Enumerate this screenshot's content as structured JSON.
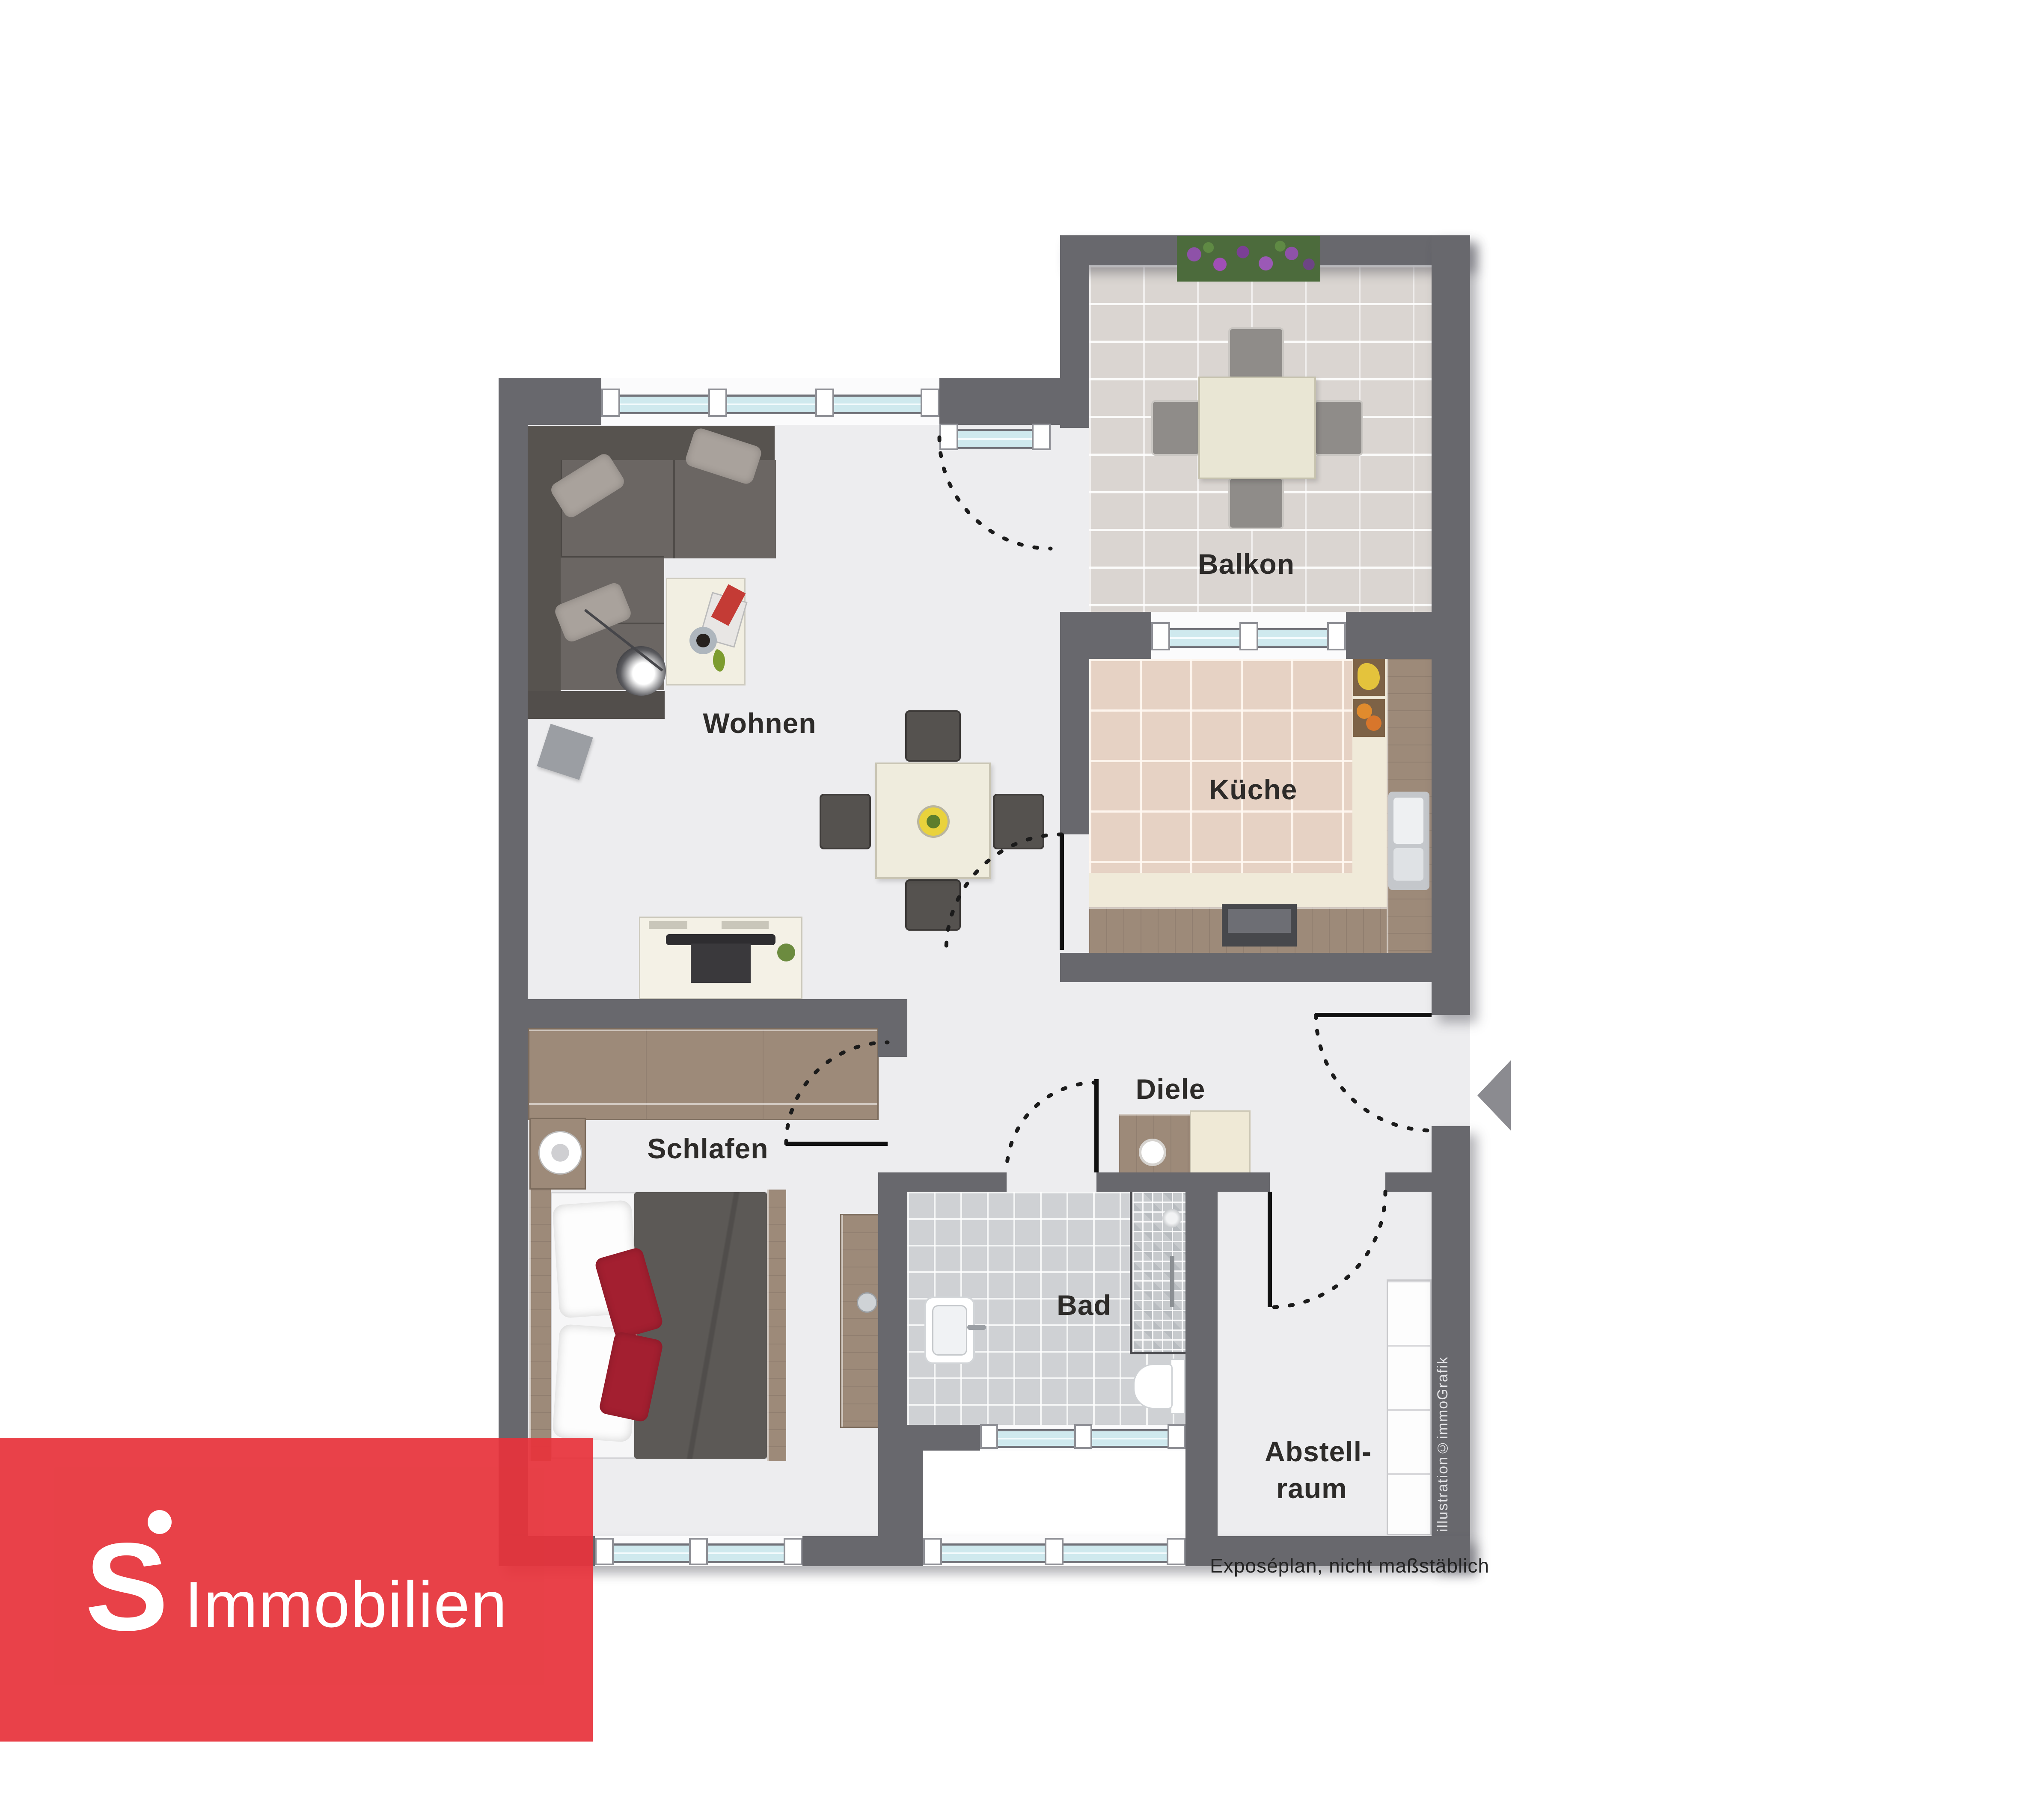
{
  "plan": {
    "rooms": {
      "wohnen": {
        "label": "Wohnen"
      },
      "balkon": {
        "label": "Balkon"
      },
      "kueche": {
        "label": "Küche"
      },
      "schlafen": {
        "label": "Schlafen"
      },
      "diele": {
        "label": "Diele"
      },
      "bad": {
        "label": "Bad"
      },
      "abstellraum": {
        "label_line1": "Abstell-",
        "label_line2": "raum"
      }
    },
    "caption": "Exposéplan, nicht maßstäblich",
    "credit_vertical": "illustration©immoGrafik"
  },
  "branding": {
    "logo_symbol": "S",
    "logo_text": "Immobilien"
  },
  "colors": {
    "brand_red": "#e7333b",
    "wall": "#68686d",
    "glass": "#cfe9ee",
    "floor": "#ededef"
  }
}
